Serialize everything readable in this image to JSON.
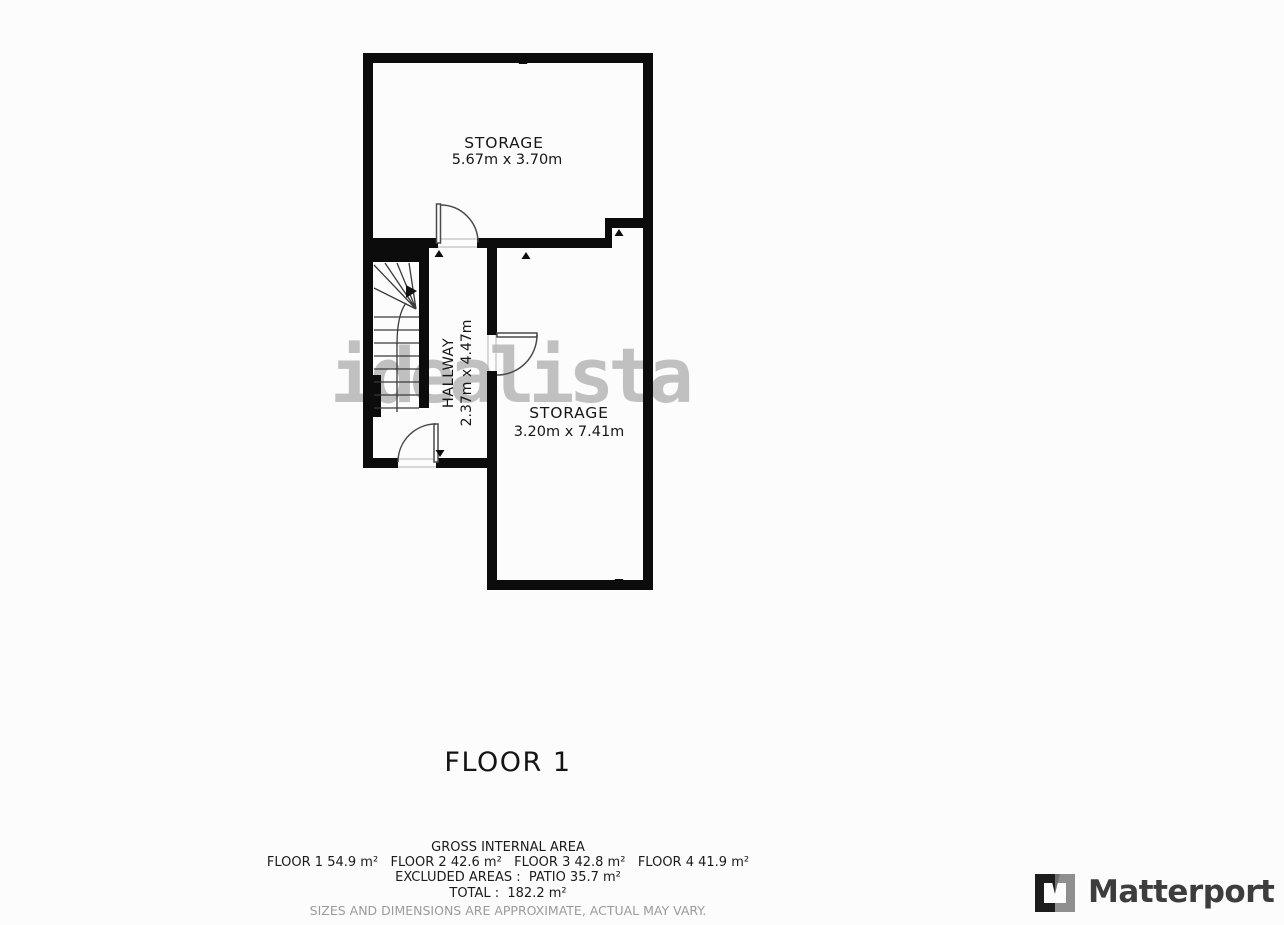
{
  "plan": {
    "watermark": "idealista",
    "floor_label": "FLOOR 1",
    "rooms": {
      "storage_top": {
        "name": "STORAGE",
        "dims": "5.67m x 3.70m"
      },
      "hallway": {
        "name": "HALLWAY",
        "dims": "2.37m x 4.47m"
      },
      "storage_bottom": {
        "name": "STORAGE",
        "dims": "3.20m x 7.41m"
      }
    }
  },
  "footer": {
    "gross_internal_area": "GROSS INTERNAL AREA",
    "floor_areas": "FLOOR 1 54.9 m²   FLOOR 2 42.6 m²   FLOOR 3 42.8 m²   FLOOR 4 41.9 m²",
    "excluded_areas": "EXCLUDED AREAS :  PATIO 35.7 m²",
    "total": "TOTAL :  182.2 m²",
    "disclaimer": "SIZES AND DIMENSIONS ARE APPROXIMATE, ACTUAL MAY VARY."
  },
  "branding": {
    "name": "Matterport"
  },
  "colors": {
    "wall": "#0c0c0c",
    "watermark_gray": "#b2b2b2",
    "logo_text_gray": "#3d3d3d",
    "disclaimer_gray": "#9b9b9b"
  }
}
